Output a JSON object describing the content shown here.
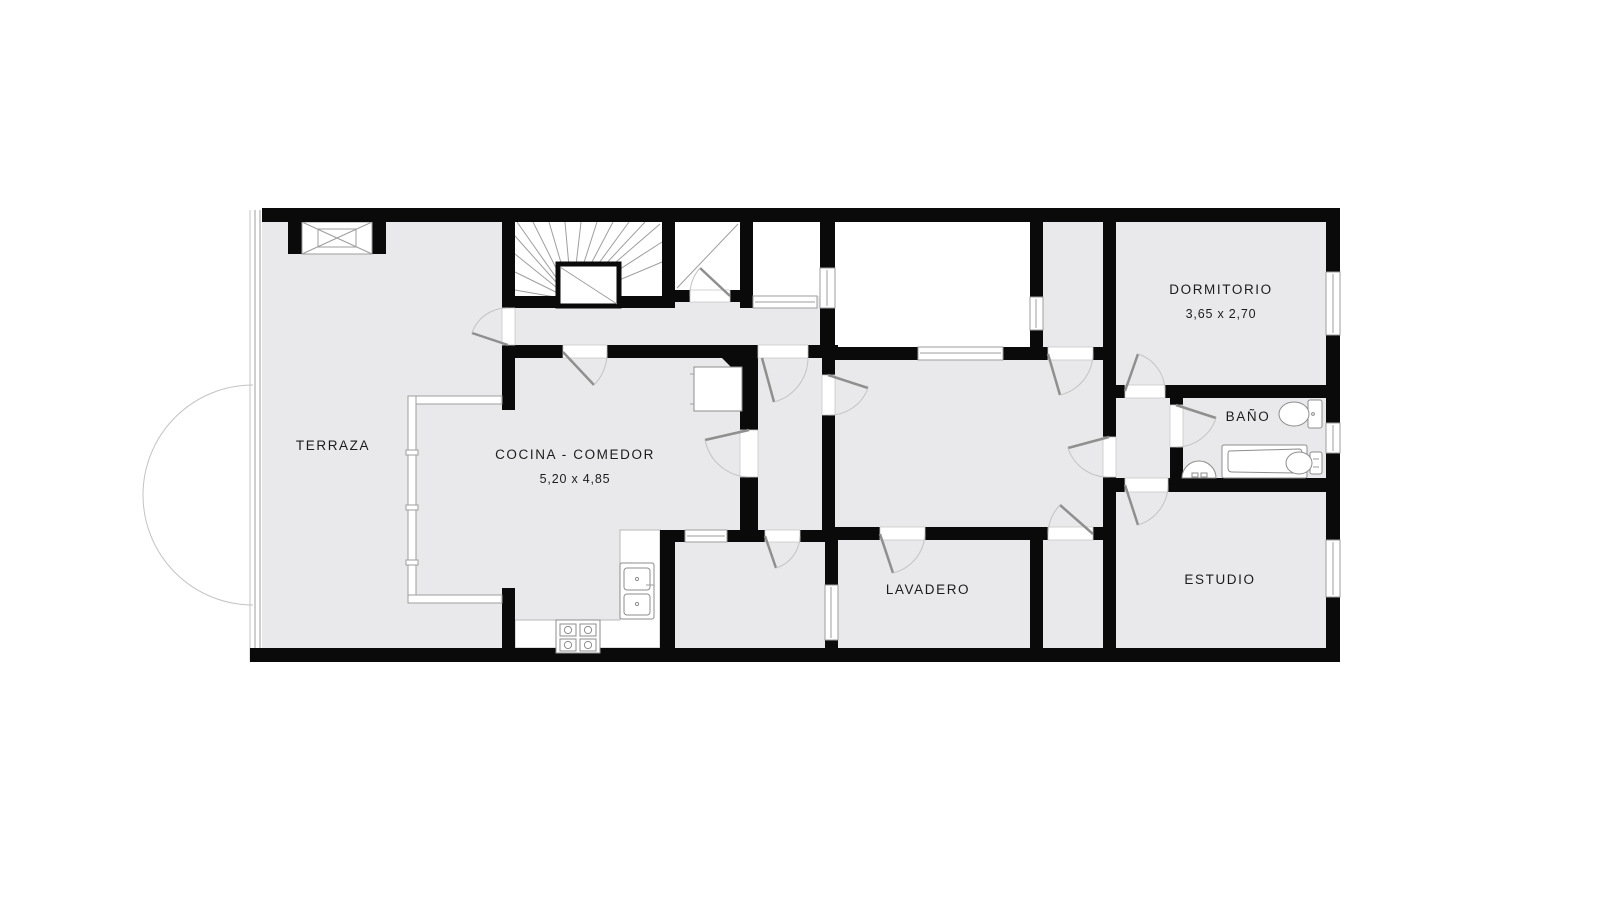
{
  "plan": {
    "rooms": {
      "terraza": {
        "label": "TERRAZA"
      },
      "cocina": {
        "label": "COCINA - COMEDOR",
        "dimensions": "5,20 x 4,85"
      },
      "lavadero": {
        "label": "LAVADERO"
      },
      "dormitorio": {
        "label": "DORMITORIO",
        "dimensions": "3,65 x 2,70"
      },
      "bano": {
        "label": "BAÑO"
      },
      "estudio": {
        "label": "ESTUDIO"
      }
    },
    "colors": {
      "wall": "#0a0a0a",
      "floor": "#e9e9eb",
      "outdoor_floor": "#e9e9eb",
      "void": "#ffffff",
      "line": "#9e9e9e",
      "text": "#1c1c1c"
    }
  }
}
